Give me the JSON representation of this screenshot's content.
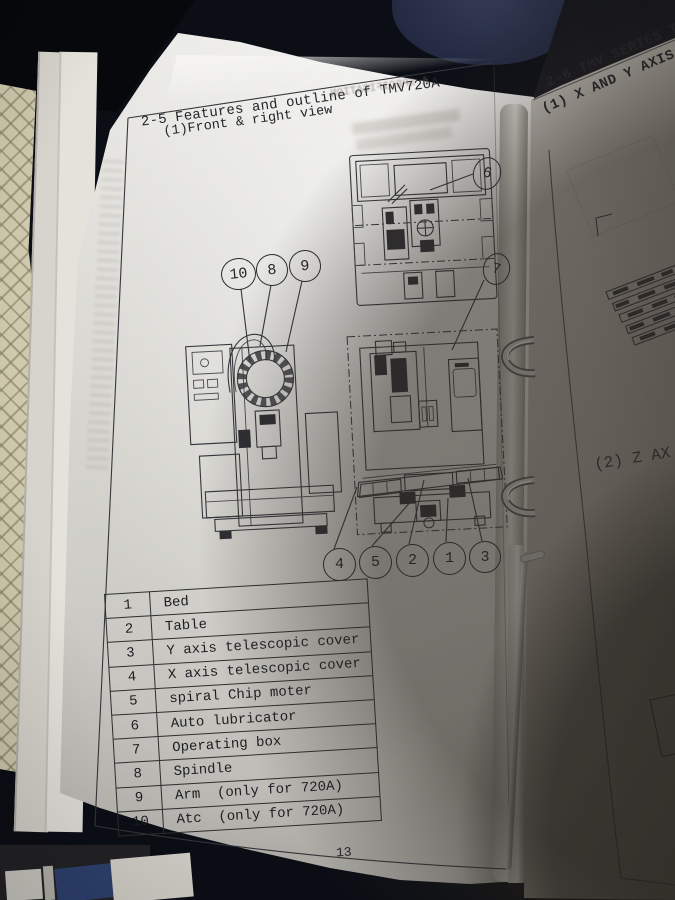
{
  "left_page": {
    "section_title": "2-5 Features and outline of TMV720A",
    "subtitle": "(1)Front & right view",
    "page_number": "13",
    "bleedthrough_text": "A SPECIFICATION"
  },
  "callouts": {
    "top": [
      "10",
      "8",
      "9"
    ],
    "right": [
      "6",
      "7"
    ],
    "bottom": [
      "4",
      "5",
      "2",
      "1",
      "3"
    ]
  },
  "parts_table": {
    "rows": [
      {
        "num": "1",
        "name": "Bed"
      },
      {
        "num": "2",
        "name": "Table"
      },
      {
        "num": "3",
        "name": "Y axis telescopic cover"
      },
      {
        "num": "4",
        "name": "X axis telescopic cover"
      },
      {
        "num": "5",
        "name": "spiral Chip moter"
      },
      {
        "num": "6",
        "name": "Auto lubricator"
      },
      {
        "num": "7",
        "name": "Operating box"
      },
      {
        "num": "8",
        "name": "Spindle"
      },
      {
        "num": "9",
        "name": "Arm  (only for 720A)"
      },
      {
        "num": "10",
        "name": "Atc  (only for 720A)"
      }
    ]
  },
  "right_page": {
    "heading_line1": "2-6 TMV SERIES T",
    "heading_line2": "(1) X AND Y AXIS",
    "section2_label": "(2) Z AX"
  },
  "colors": {
    "paper": "#d7d5cf",
    "ink": "#2b2b2b",
    "background": "#0b0e15",
    "mat": "#cfc9ad",
    "cover_blue": "#2f4270"
  }
}
